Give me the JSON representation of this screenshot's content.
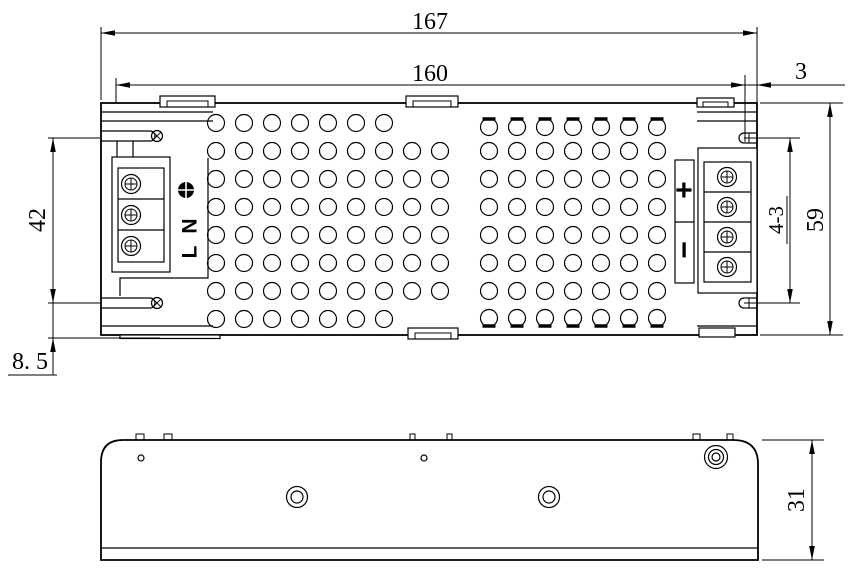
{
  "drawing_title": "power-supply-enclosure-dimension-drawing",
  "colors": {
    "line": "#000000",
    "background": "#ffffff"
  },
  "dimensions": {
    "overall_length": "167",
    "body_length": "160",
    "right_end_offset": "3",
    "mount_hole_spacing": "42",
    "mount_hole_edge_offset": "8. 5",
    "body_width": "59",
    "mount_hole_callout": "4-3",
    "body_height": "31"
  },
  "terminals": {
    "input": {
      "ground_icon": "earth-ground-icon",
      "neutral_label": "N",
      "line_label": "L",
      "screw_count": 3
    },
    "output": {
      "positive_label": "+",
      "negative_label": "−",
      "screw_count": 4
    }
  },
  "vent_grid": {
    "hole_radius": 8.5,
    "pitch": 28,
    "rows_y": [
      123,
      151,
      179,
      207,
      235,
      263,
      291,
      319
    ],
    "left_cols_x": [
      216,
      244,
      272,
      300,
      328,
      356,
      384,
      412,
      440
    ],
    "left_row_cols": [
      7,
      9,
      9,
      9,
      9,
      9,
      9,
      7
    ],
    "right_cols_x": [
      489,
      517,
      545,
      573,
      601,
      629,
      657
    ],
    "right_clipped_top_y": 127,
    "right_clipped_bottom_y": 318
  }
}
